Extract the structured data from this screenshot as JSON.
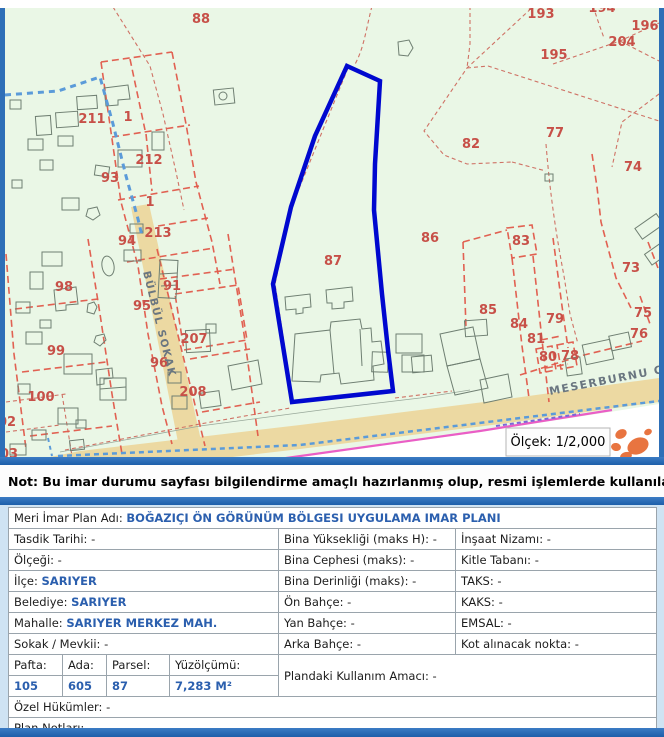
{
  "map": {
    "scale_label": "Ölçek: 1/2,000",
    "highlighted_parcel": "87",
    "streets": [
      {
        "name": "BÜLBÜL SOKAK"
      },
      {
        "name": "MESERBURNU CADD"
      }
    ],
    "labels": [
      {
        "t": "88",
        "x": 201,
        "y": 19
      },
      {
        "t": "193",
        "x": 541,
        "y": 14
      },
      {
        "t": "194",
        "x": 602,
        "y": 8
      },
      {
        "t": "196",
        "x": 645,
        "y": 26
      },
      {
        "t": "204",
        "x": 622,
        "y": 42
      },
      {
        "t": "195",
        "x": 554,
        "y": 55
      },
      {
        "t": "77",
        "x": 555,
        "y": 133
      },
      {
        "t": "82",
        "x": 471,
        "y": 144
      },
      {
        "t": "74",
        "x": 633,
        "y": 167
      },
      {
        "t": "211",
        "x": 92,
        "y": 119
      },
      {
        "t": "1",
        "x": 128,
        "y": 117
      },
      {
        "t": "212",
        "x": 149,
        "y": 160
      },
      {
        "t": "93",
        "x": 110,
        "y": 178
      },
      {
        "t": "1",
        "x": 150,
        "y": 202
      },
      {
        "t": "213",
        "x": 158,
        "y": 233
      },
      {
        "t": "94",
        "x": 127,
        "y": 241
      },
      {
        "t": "86",
        "x": 430,
        "y": 238
      },
      {
        "t": "98",
        "x": 64,
        "y": 287
      },
      {
        "t": "91",
        "x": 172,
        "y": 286
      },
      {
        "t": "95",
        "x": 142,
        "y": 306
      },
      {
        "t": "99",
        "x": 56,
        "y": 351
      },
      {
        "t": "207",
        "x": 194,
        "y": 339
      },
      {
        "t": "96",
        "x": 159,
        "y": 363
      },
      {
        "t": "208",
        "x": 193,
        "y": 392
      },
      {
        "t": "100",
        "x": 41,
        "y": 397
      },
      {
        "t": "02",
        "x": 7,
        "y": 422
      },
      {
        "t": "03",
        "x": 9,
        "y": 454
      },
      {
        "t": "83",
        "x": 521,
        "y": 241
      },
      {
        "t": "73",
        "x": 631,
        "y": 268
      },
      {
        "t": "85",
        "x": 488,
        "y": 310
      },
      {
        "t": "84",
        "x": 519,
        "y": 324
      },
      {
        "t": "79",
        "x": 555,
        "y": 319
      },
      {
        "t": "75",
        "x": 643,
        "y": 313
      },
      {
        "t": "76",
        "x": 639,
        "y": 334
      },
      {
        "t": "81",
        "x": 536,
        "y": 339
      },
      {
        "t": "80",
        "x": 548,
        "y": 357
      },
      {
        "t": "78",
        "x": 570,
        "y": 356
      },
      {
        "t": "87",
        "x": 333,
        "y": 261
      }
    ],
    "colors": {
      "background": "#eaf7e6",
      "parcel_line": "#e0584a",
      "highlight": "#0008cf",
      "road": "#ecd9a2",
      "stream": "#5b9bd9",
      "magenta": "#ea5ec6",
      "logo": "#e87440"
    }
  },
  "note": {
    "text": "Not: Bu imar durumu sayfası bilgilendirme amaçlı hazırlanmış olup, resmi işlemlerde kullanılamaz."
  },
  "table": {
    "plan_row": {
      "l": "Meri İmar Plan Adı:",
      "v": "BOĞAZIÇI ÖN GÖRÜNÜM BÖLGESI UYGULAMA IMAR PLANI"
    },
    "grid": [
      [
        {
          "l": "Tasdik Tarihi:",
          "v": "-"
        },
        {
          "l": "Bina Yüksekliği (maks H):",
          "v": "-"
        },
        {
          "l": "İnşaat Nizamı:",
          "v": "-"
        }
      ],
      [
        {
          "l": "Ölçeği:",
          "v": "-"
        },
        {
          "l": "Bina Cephesi (maks):",
          "v": "-"
        },
        {
          "l": "Kitle Tabanı:",
          "v": "-"
        }
      ],
      [
        {
          "l": "İlçe:",
          "v": "SARIYER"
        },
        {
          "l": "Bina Derinliği (maks):",
          "v": "-"
        },
        {
          "l": "TAKS:",
          "v": "-"
        }
      ],
      [
        {
          "l": "Belediye:",
          "v": "SARIYER"
        },
        {
          "l": "Ön Bahçe:",
          "v": "-"
        },
        {
          "l": "KAKS:",
          "v": "-"
        }
      ],
      [
        {
          "l": "Mahalle:",
          "v": "SARIYER MERKEZ MAH."
        },
        {
          "l": "Yan Bahçe:",
          "v": "-"
        },
        {
          "l": "EMSAL:",
          "v": "-"
        }
      ],
      [
        {
          "l": "Sokak / Mevkii:",
          "v": "-"
        },
        {
          "l": "Arka Bahçe:",
          "v": "-"
        },
        {
          "l": "Kot alınacak nokta:",
          "v": "-"
        }
      ]
    ],
    "parcel": {
      "h": [
        "Pafta:",
        "Ada:",
        "Parsel:",
        "Yüzölçümü:"
      ],
      "v": [
        "105",
        "605",
        "87",
        "7,283 M²"
      ]
    },
    "kullanim": {
      "l": "Plandaki Kullanım Amacı:",
      "v": "-"
    },
    "ozel": {
      "l": "Özel Hükümler:",
      "v": "-"
    },
    "plan_not": {
      "l": "Plan Notları:",
      "v": "-"
    }
  }
}
